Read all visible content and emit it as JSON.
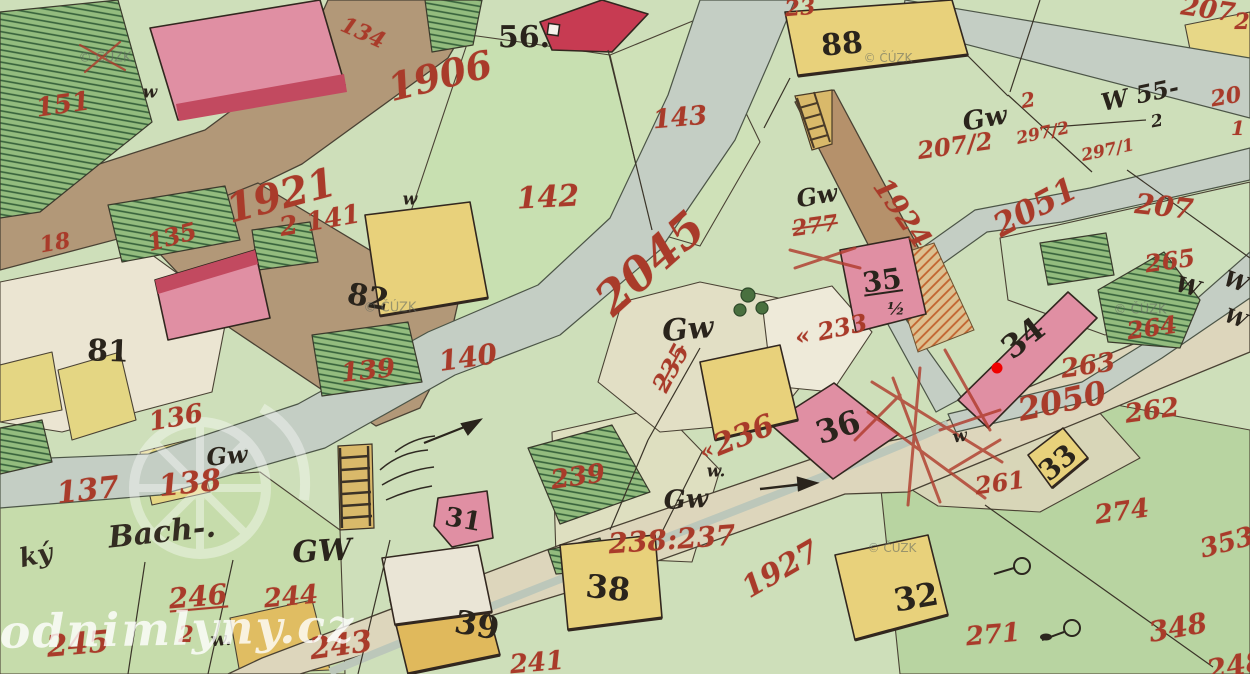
{
  "map": {
    "kind": "historical cadastral map scan",
    "palette": {
      "paper_green": "#cedfba",
      "meadow_green": "#b8d4a1",
      "orchard_hatch_green": "#93bc7e",
      "road_brown": "#b29878",
      "road_pale": "#ddd6bc",
      "water_grey": "#c4cec4",
      "building_masonry_pink": "#e08fa3",
      "building_masonry_red": "#c73b52",
      "building_wood_yellow": "#e8d17b",
      "ink_red": "#a93b2a",
      "ink_black": "#2a241c",
      "watermark_white": "rgba(255,255,255,0.8)",
      "mill_marker_red": "#f00000"
    }
  },
  "labels": [
    {
      "t": "151",
      "x": 63,
      "y": 105,
      "s": 26,
      "r": -8,
      "k": "parcel"
    },
    {
      "t": "134",
      "x": 363,
      "y": 33,
      "s": 22,
      "r": 24,
      "k": "parcel"
    },
    {
      "t": "1906",
      "x": 440,
      "y": 76,
      "s": 38,
      "r": -14,
      "k": "parcel"
    },
    {
      "t": "143",
      "x": 680,
      "y": 118,
      "s": 26,
      "r": -5,
      "k": "parcel"
    },
    {
      "t": "142",
      "x": 548,
      "y": 198,
      "s": 30,
      "r": -3,
      "k": "parcel"
    },
    {
      "t": "1921",
      "x": 281,
      "y": 196,
      "s": 40,
      "r": -15,
      "k": "parcel"
    },
    {
      "t": "2 141",
      "x": 320,
      "y": 221,
      "s": 26,
      "r": -10,
      "k": "parcel"
    },
    {
      "t": "135",
      "x": 172,
      "y": 237,
      "s": 24,
      "r": -15,
      "k": "parcel"
    },
    {
      "t": "18",
      "x": 55,
      "y": 243,
      "s": 22,
      "r": -10,
      "k": "parcel"
    },
    {
      "t": "140",
      "x": 468,
      "y": 358,
      "s": 28,
      "r": -8,
      "k": "parcel"
    },
    {
      "t": "136",
      "x": 176,
      "y": 418,
      "s": 26,
      "r": -10,
      "k": "parcel"
    },
    {
      "t": "139",
      "x": 368,
      "y": 371,
      "s": 26,
      "r": -6,
      "k": "parcel"
    },
    {
      "t": "239",
      "x": 578,
      "y": 477,
      "s": 26,
      "r": -8,
      "k": "parcel"
    },
    {
      "t": "137",
      "x": 88,
      "y": 491,
      "s": 30,
      "r": -6,
      "k": "parcel"
    },
    {
      "t": "138",
      "x": 190,
      "y": 484,
      "s": 30,
      "r": -6,
      "k": "parcel"
    },
    {
      "t": "245",
      "x": 78,
      "y": 645,
      "s": 30,
      "r": -5,
      "k": "parcel"
    },
    {
      "t": "246",
      "x": 198,
      "y": 597,
      "s": 28,
      "r": -5,
      "k": "parcel",
      "u": true
    },
    {
      "t": "2",
      "x": 186,
      "y": 635,
      "s": 22,
      "r": 0,
      "k": "parcel"
    },
    {
      "t": "244",
      "x": 291,
      "y": 597,
      "s": 26,
      "r": -5,
      "k": "parcel"
    },
    {
      "t": "243",
      "x": 341,
      "y": 646,
      "s": 30,
      "r": -8,
      "k": "parcel"
    },
    {
      "t": "241",
      "x": 537,
      "y": 663,
      "s": 26,
      "r": -5,
      "k": "parcel"
    },
    {
      "t": "2045",
      "x": 650,
      "y": 263,
      "s": 46,
      "r": -42,
      "k": "parcel"
    },
    {
      "t": "235",
      "x": 671,
      "y": 368,
      "s": 24,
      "r": -62,
      "k": "parcel",
      "st": true
    },
    {
      "t": "«",
      "x": 707,
      "y": 451,
      "s": 22,
      "r": -20,
      "k": "parcel"
    },
    {
      "t": "236",
      "x": 744,
      "y": 436,
      "s": 30,
      "r": -22,
      "k": "parcel"
    },
    {
      "t": "« 233",
      "x": 831,
      "y": 330,
      "s": 24,
      "r": -12,
      "k": "parcel"
    },
    {
      "t": "238:237",
      "x": 672,
      "y": 540,
      "s": 28,
      "r": -4,
      "k": "parcel"
    },
    {
      "t": "1927",
      "x": 781,
      "y": 570,
      "s": 30,
      "r": -30,
      "k": "parcel"
    },
    {
      "t": "277",
      "x": 815,
      "y": 226,
      "s": 22,
      "r": -8,
      "k": "parcel",
      "st": true
    },
    {
      "t": "1924",
      "x": 902,
      "y": 213,
      "s": 28,
      "r": 55,
      "k": "parcel"
    },
    {
      "t": "207/2",
      "x": 955,
      "y": 146,
      "s": 24,
      "r": -8,
      "k": "parcel"
    },
    {
      "t": "2",
      "x": 1028,
      "y": 100,
      "s": 20,
      "r": -10,
      "k": "parcel"
    },
    {
      "t": "297/2",
      "x": 1043,
      "y": 134,
      "s": 17,
      "r": -12,
      "k": "parcel"
    },
    {
      "t": "297/1",
      "x": 1108,
      "y": 151,
      "s": 17,
      "r": -12,
      "k": "parcel"
    },
    {
      "t": "2051",
      "x": 1035,
      "y": 207,
      "s": 32,
      "r": -28,
      "k": "parcel"
    },
    {
      "t": "207",
      "x": 1164,
      "y": 207,
      "s": 28,
      "r": 6,
      "k": "parcel"
    },
    {
      "t": "207",
      "x": 1208,
      "y": 10,
      "s": 26,
      "r": 8,
      "k": "parcel"
    },
    {
      "t": "2",
      "x": 1242,
      "y": 22,
      "s": 22,
      "r": 0,
      "k": "parcel"
    },
    {
      "t": "20",
      "x": 1226,
      "y": 97,
      "s": 22,
      "r": -10,
      "k": "parcel"
    },
    {
      "t": "1",
      "x": 1238,
      "y": 128,
      "s": 20,
      "r": 0,
      "k": "parcel"
    },
    {
      "t": "265",
      "x": 1170,
      "y": 261,
      "s": 24,
      "r": -8,
      "k": "parcel"
    },
    {
      "t": "264",
      "x": 1152,
      "y": 328,
      "s": 24,
      "r": -8,
      "k": "parcel"
    },
    {
      "t": "263",
      "x": 1088,
      "y": 366,
      "s": 26,
      "r": -8,
      "k": "parcel"
    },
    {
      "t": "2050",
      "x": 1062,
      "y": 401,
      "s": 32,
      "r": -12,
      "k": "parcel"
    },
    {
      "t": "262",
      "x": 1152,
      "y": 411,
      "s": 26,
      "r": -8,
      "k": "parcel"
    },
    {
      "t": "261",
      "x": 1000,
      "y": 483,
      "s": 24,
      "r": -8,
      "k": "parcel"
    },
    {
      "t": "274",
      "x": 1122,
      "y": 512,
      "s": 26,
      "r": -8,
      "k": "parcel"
    },
    {
      "t": "271",
      "x": 993,
      "y": 635,
      "s": 26,
      "r": -5,
      "k": "parcel"
    },
    {
      "t": "348",
      "x": 1178,
      "y": 628,
      "s": 28,
      "r": -10,
      "k": "parcel"
    },
    {
      "t": "353",
      "x": 1227,
      "y": 543,
      "s": 26,
      "r": -15,
      "k": "parcel"
    },
    {
      "t": "248",
      "x": 1236,
      "y": 666,
      "s": 28,
      "r": -10,
      "k": "parcel"
    },
    {
      "t": "23",
      "x": 800,
      "y": 8,
      "s": 22,
      "r": -5,
      "k": "parcel"
    },
    {
      "t": "56.",
      "x": 524,
      "y": 38,
      "s": 30,
      "r": 0,
      "k": "house"
    },
    {
      "t": "88",
      "x": 842,
      "y": 45,
      "s": 30,
      "r": -5,
      "k": "house"
    },
    {
      "t": "81",
      "x": 108,
      "y": 352,
      "s": 30,
      "r": 2,
      "k": "house"
    },
    {
      "t": "82",
      "x": 368,
      "y": 298,
      "s": 30,
      "r": 10,
      "k": "house"
    },
    {
      "t": "31",
      "x": 463,
      "y": 520,
      "s": 26,
      "r": 10,
      "k": "house"
    },
    {
      "t": "35",
      "x": 882,
      "y": 281,
      "s": 28,
      "r": -8,
      "k": "house",
      "u": true
    },
    {
      "t": "34",
      "x": 1023,
      "y": 338,
      "s": 32,
      "r": -38,
      "k": "house"
    },
    {
      "t": "36",
      "x": 838,
      "y": 427,
      "s": 32,
      "r": -18,
      "k": "house"
    },
    {
      "t": "38",
      "x": 608,
      "y": 588,
      "s": 32,
      "r": 6,
      "k": "house"
    },
    {
      "t": "39",
      "x": 477,
      "y": 625,
      "s": 32,
      "r": 10,
      "k": "house"
    },
    {
      "t": "32",
      "x": 916,
      "y": 597,
      "s": 32,
      "r": -10,
      "k": "house"
    },
    {
      "t": "33",
      "x": 1058,
      "y": 463,
      "s": 28,
      "r": -40,
      "k": "house"
    },
    {
      "t": "½",
      "x": 896,
      "y": 310,
      "s": 17,
      "r": 0,
      "k": "mark"
    },
    {
      "t": "Gw",
      "x": 688,
      "y": 330,
      "s": 30,
      "r": -5,
      "k": "mark"
    },
    {
      "t": "Gw",
      "x": 227,
      "y": 456,
      "s": 24,
      "r": -5,
      "k": "mark"
    },
    {
      "t": "GW",
      "x": 322,
      "y": 552,
      "s": 30,
      "r": -3,
      "k": "mark"
    },
    {
      "t": "Gw",
      "x": 686,
      "y": 500,
      "s": 26,
      "r": -3,
      "k": "mark"
    },
    {
      "t": "Gw",
      "x": 817,
      "y": 196,
      "s": 24,
      "r": -10,
      "k": "mark"
    },
    {
      "t": "Gw",
      "x": 985,
      "y": 119,
      "s": 26,
      "r": -10,
      "k": "mark"
    },
    {
      "t": "W 55-",
      "x": 1140,
      "y": 95,
      "s": 24,
      "r": -12,
      "k": "mark"
    },
    {
      "t": "2",
      "x": 1157,
      "y": 122,
      "s": 17,
      "r": -10,
      "k": "mark"
    },
    {
      "t": "w",
      "x": 150,
      "y": 93,
      "s": 17,
      "r": 0,
      "k": "mark"
    },
    {
      "t": "w",
      "x": 410,
      "y": 200,
      "s": 17,
      "r": 0,
      "k": "mark"
    },
    {
      "t": "w.",
      "x": 716,
      "y": 472,
      "s": 17,
      "r": 0,
      "k": "mark"
    },
    {
      "t": "w.",
      "x": 221,
      "y": 640,
      "s": 19,
      "r": -5,
      "k": "mark"
    },
    {
      "t": "w",
      "x": 960,
      "y": 437,
      "s": 17,
      "r": -10,
      "k": "mark"
    },
    {
      "t": "W",
      "x": 1188,
      "y": 287,
      "s": 22,
      "r": 15,
      "k": "mark"
    },
    {
      "t": "W",
      "x": 1236,
      "y": 282,
      "s": 22,
      "r": 20,
      "k": "mark"
    },
    {
      "t": "W",
      "x": 1236,
      "y": 318,
      "s": 20,
      "r": 20,
      "k": "mark"
    },
    {
      "t": "ký",
      "x": 36,
      "y": 556,
      "s": 26,
      "r": -12,
      "k": "stream"
    },
    {
      "t": "Bach-.",
      "x": 162,
      "y": 533,
      "s": 30,
      "r": -6,
      "k": "stream"
    },
    {
      "t": "© ČÚZK",
      "x": 105,
      "y": 58,
      "s": 13,
      "r": 0,
      "k": "wm"
    },
    {
      "t": "© ČÚZK",
      "x": 888,
      "y": 58,
      "s": 12,
      "r": 0,
      "k": "wm"
    },
    {
      "t": "© ČÚZK",
      "x": 390,
      "y": 308,
      "s": 13,
      "r": 0,
      "k": "wm"
    },
    {
      "t": "© ČÚZK",
      "x": 1140,
      "y": 310,
      "s": 13,
      "r": 0,
      "k": "wm"
    },
    {
      "t": "© ČÚZK",
      "x": 892,
      "y": 548,
      "s": 12,
      "r": 0,
      "k": "wm"
    },
    {
      "t": "vodnimlyny.cz",
      "x": 163,
      "y": 629,
      "s": 46,
      "r": -1,
      "k": "site"
    }
  ]
}
